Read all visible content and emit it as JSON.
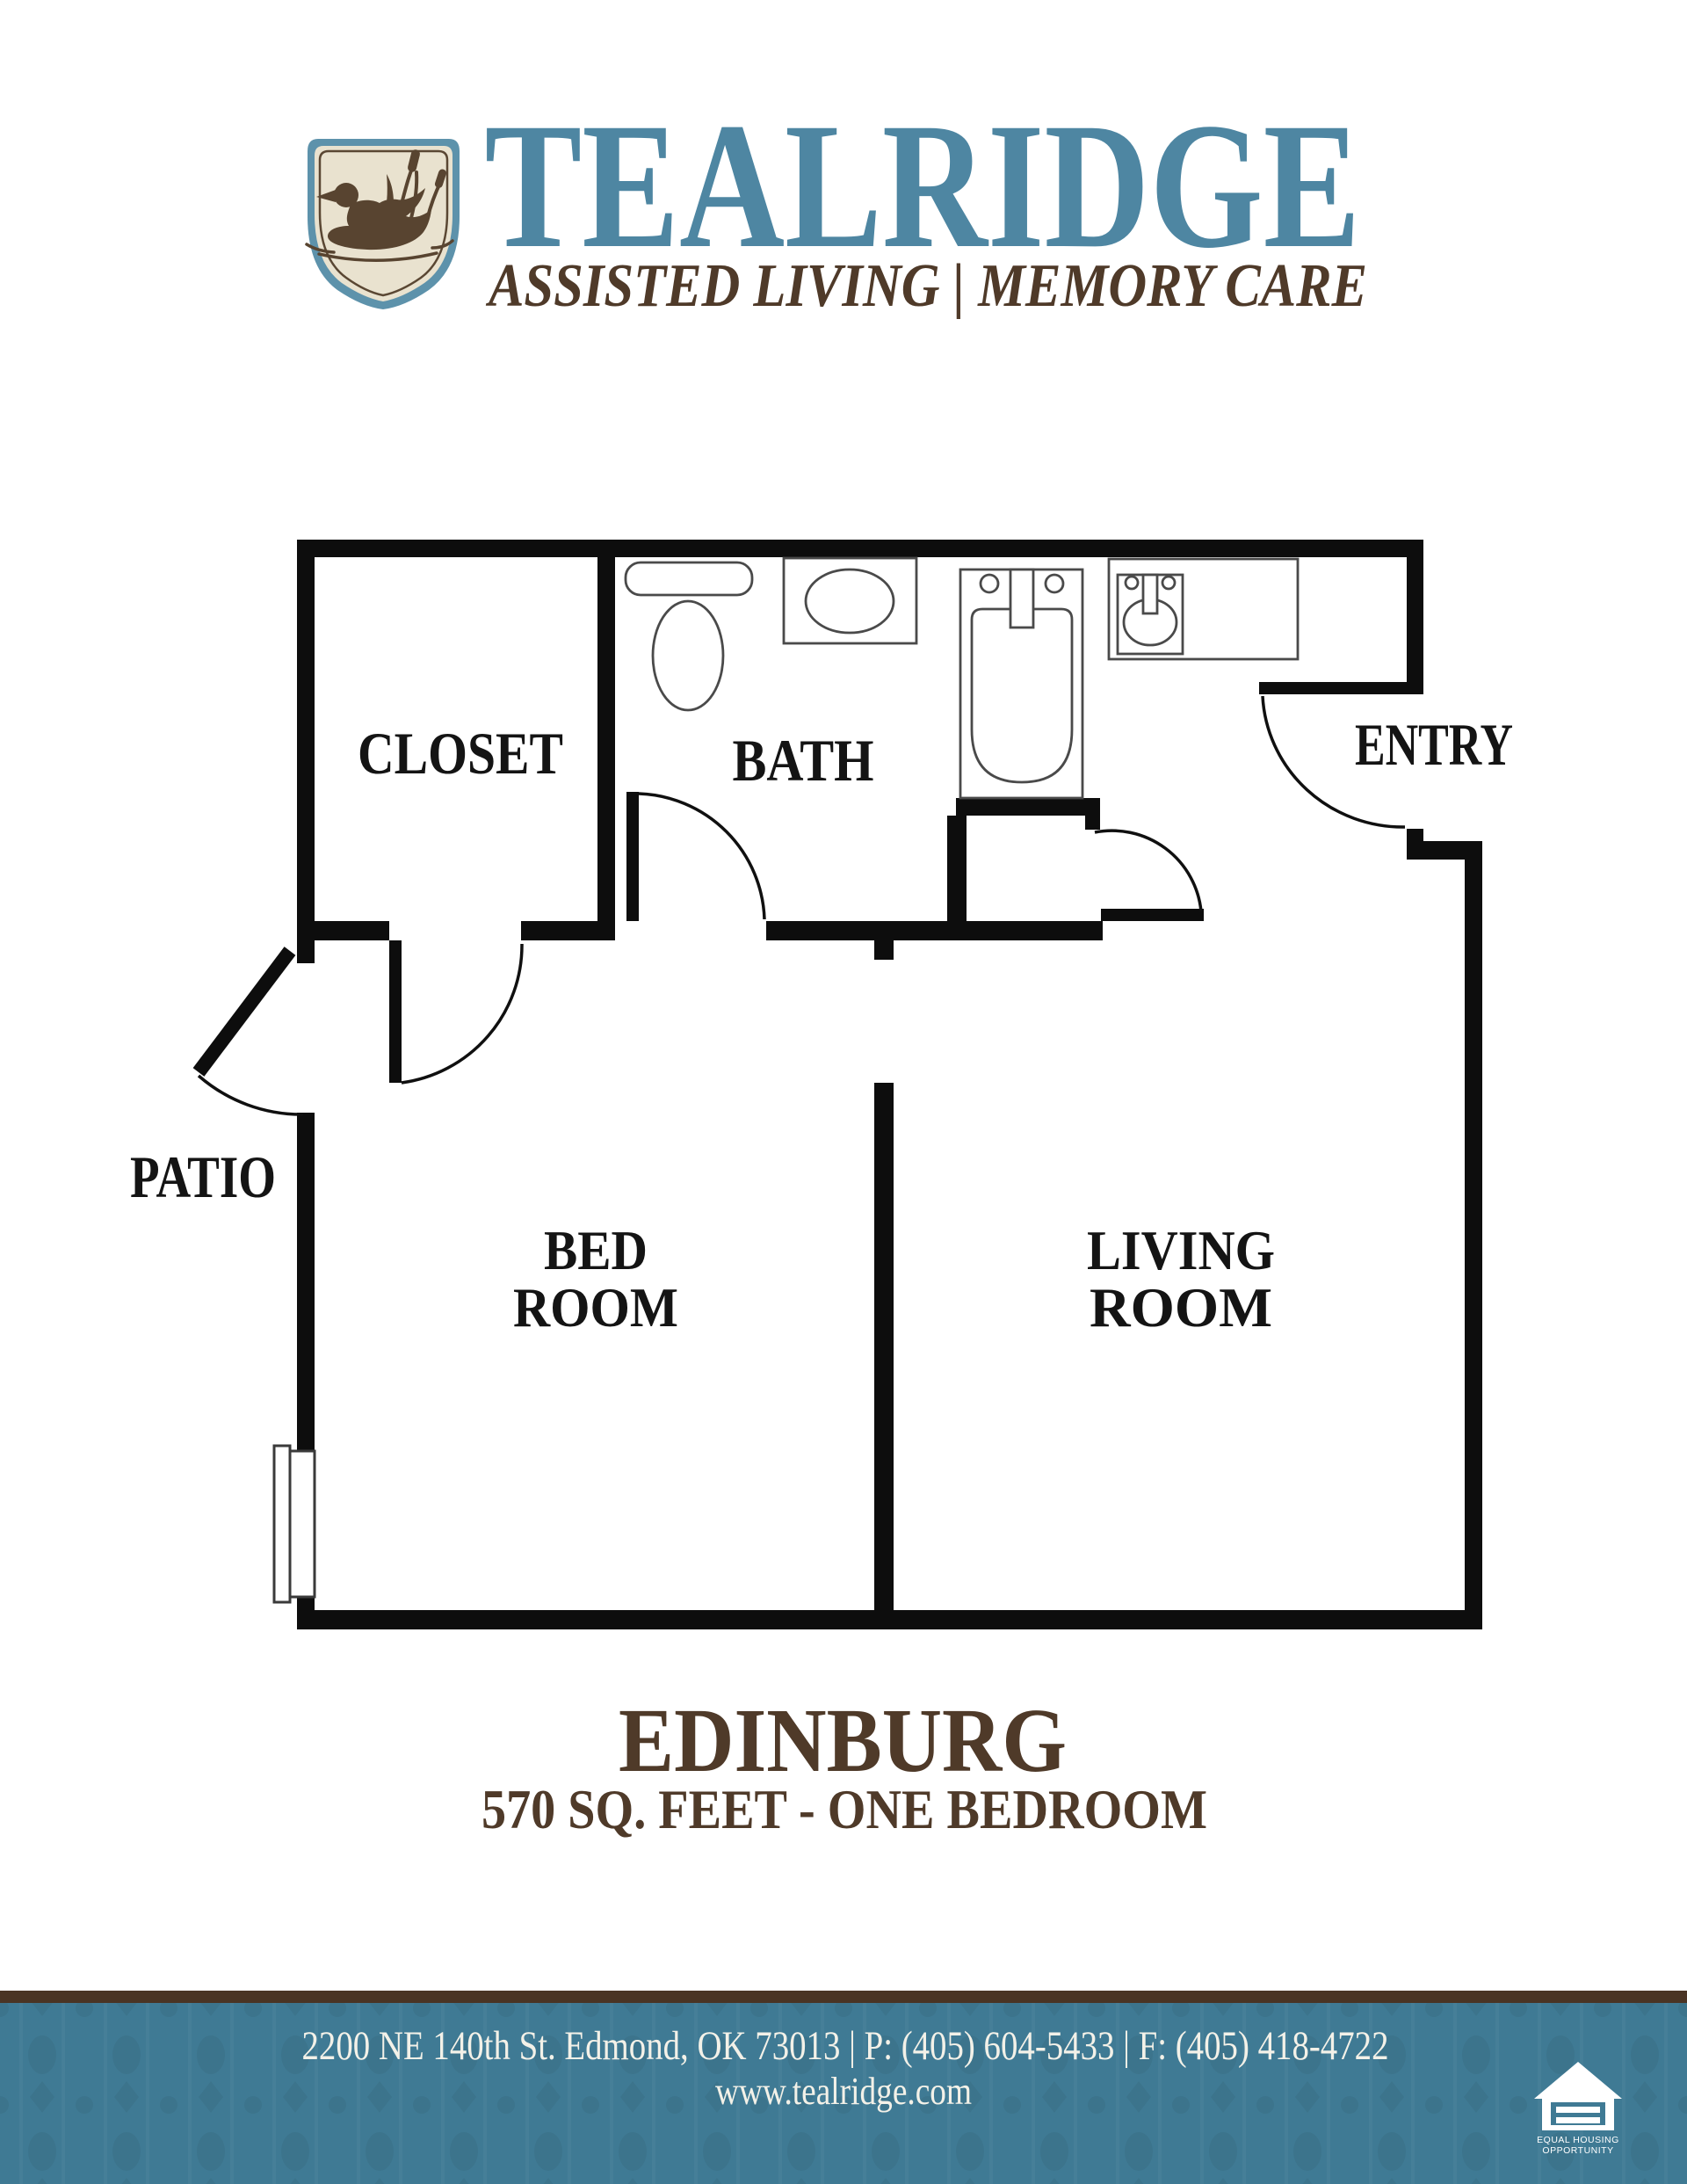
{
  "brand": {
    "name": "TEALRIDGE",
    "tagline": "ASSISTED LIVING | MEMORY CARE"
  },
  "icons": {
    "logo": "duck-shield-icon",
    "footer_logo": "equal-housing-icon"
  },
  "floor_plan": {
    "rooms": {
      "closet": "CLOSET",
      "bath": "BATH",
      "entry": "ENTRY",
      "patio": "PATIO",
      "bedroom_line1": "BED",
      "bedroom_line2": "ROOM",
      "living_line1": "LIVING",
      "living_line2": "ROOM"
    }
  },
  "unit": {
    "name": "EDINBURG",
    "specs": "570 SQ. FEET - ONE BEDROOM"
  },
  "footer": {
    "contact": "2200 NE 140th St. Edmond, OK 73013 | P: (405) 604-5433 | F: (405) 418-4722",
    "website": "www.tealridge.com",
    "equal_housing_line1": "EQUAL HOUSING",
    "equal_housing_line2": "OPPORTUNITY"
  },
  "colors": {
    "teal_primary": "#4e86a2",
    "brown_primary": "#4f3a29",
    "footer_teal": "#3f7a94",
    "bar_brown": "#4a3424",
    "plan_black": "#0d0d0d",
    "shield_cream": "#e9e2cf",
    "shield_teal_border": "#5d92ab",
    "duck_brown": "#584430"
  }
}
